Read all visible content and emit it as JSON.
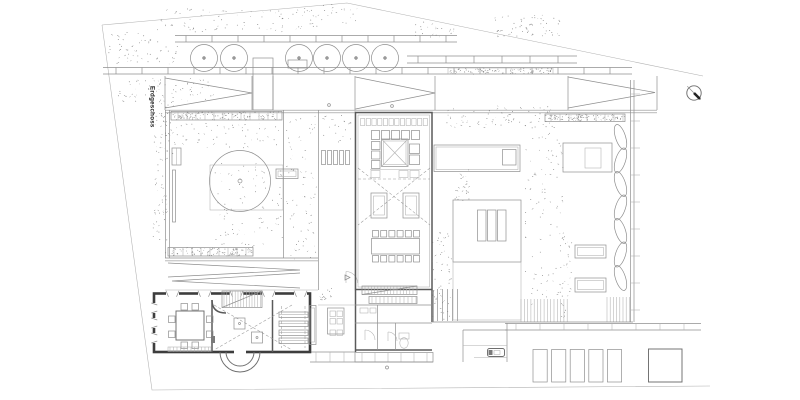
{
  "drawing": {
    "floor_label": "Erdgeschoss",
    "background": "#ffffff",
    "line_color": "#8f8f8f",
    "heavy_wall_color": "#3d3d3d",
    "label_color": "#1c1c1c",
    "top_row_tree_count": 6,
    "courtyard_tree_count": 1,
    "parking_stall_count": 5,
    "north_arrow_icon": "compass-north-arrow"
  }
}
